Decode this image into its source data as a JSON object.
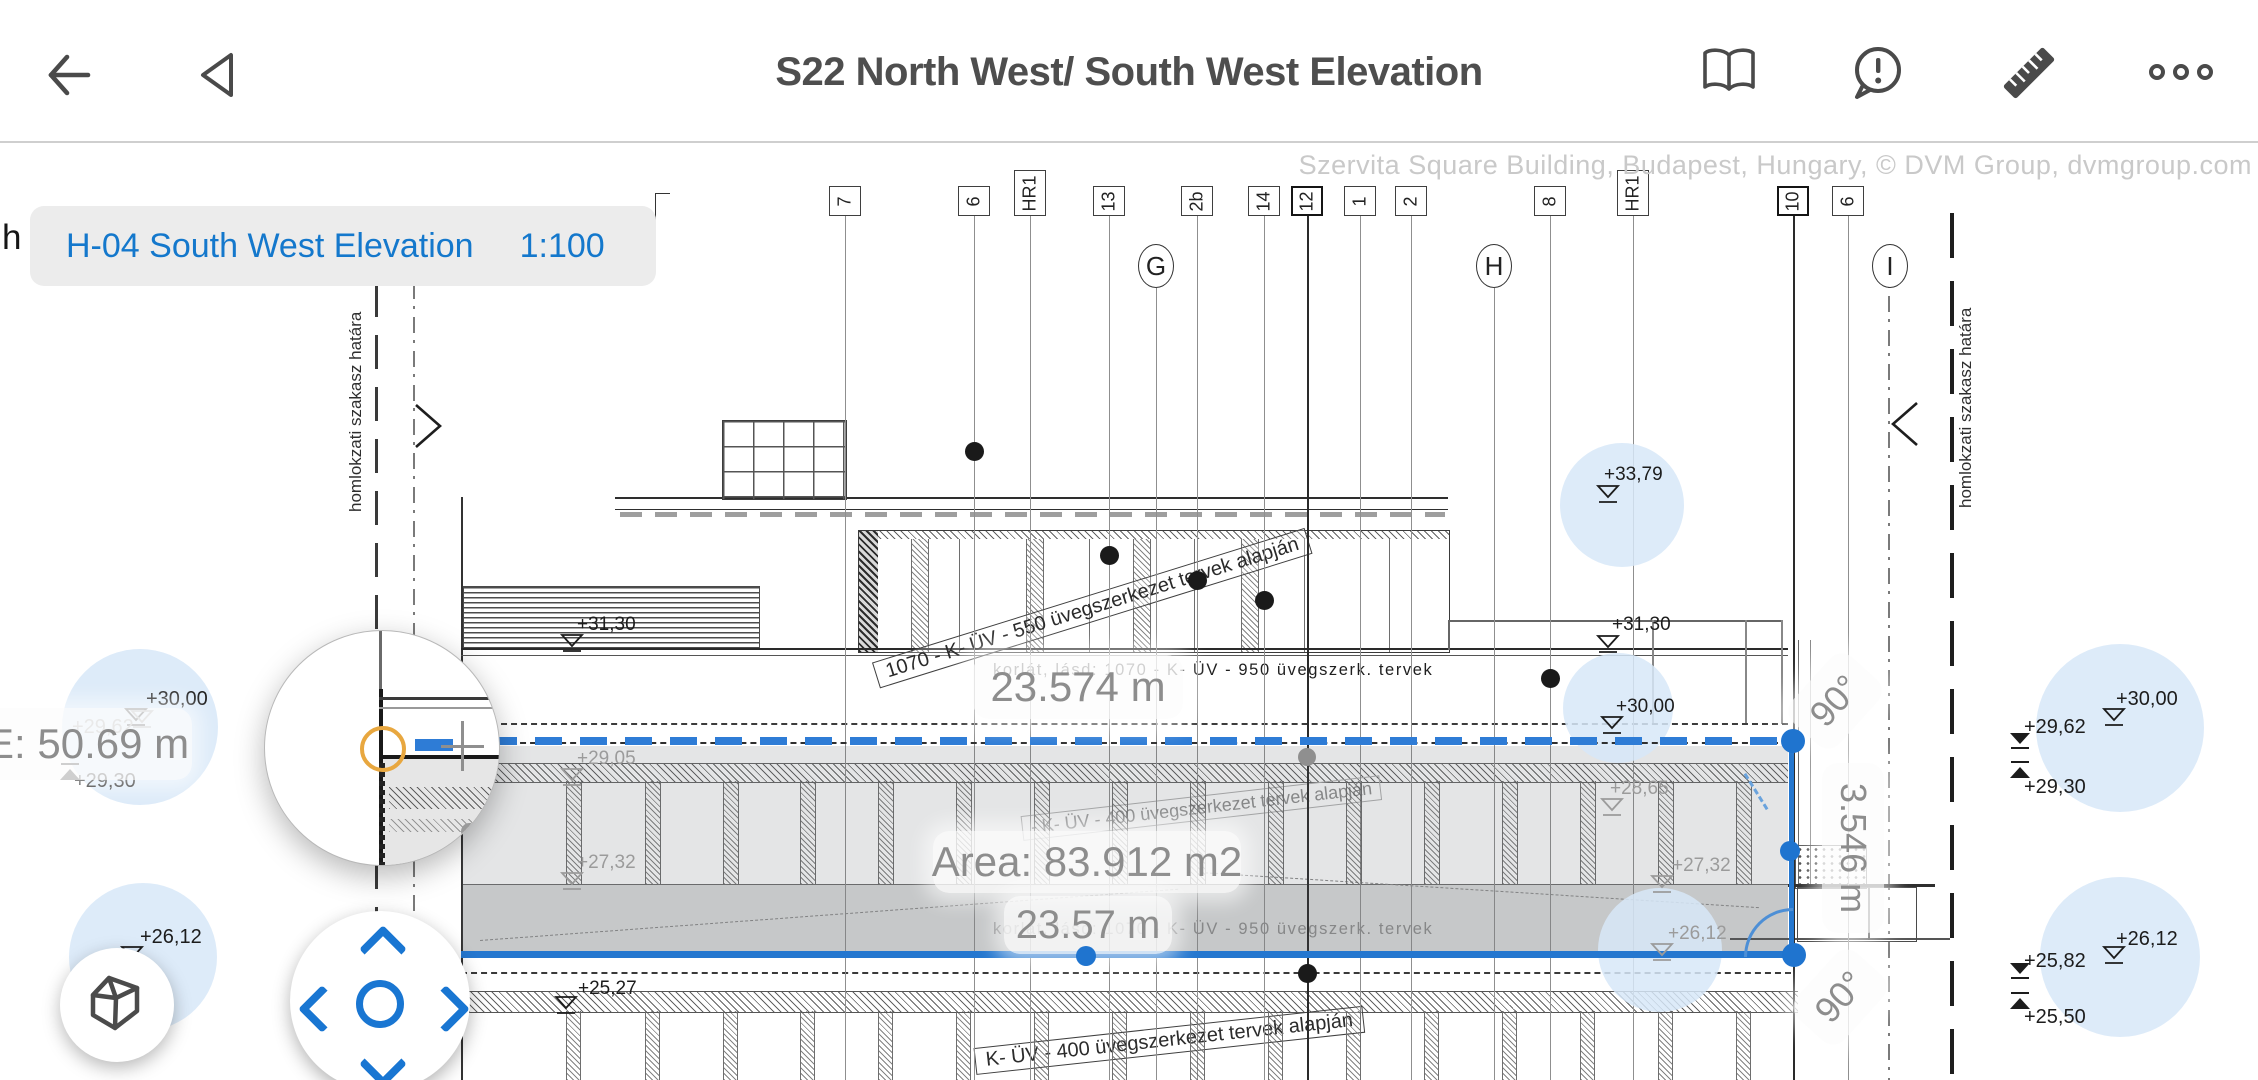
{
  "toolbar": {
    "title": "S22 North West/ South West Elevation"
  },
  "chip": {
    "label": "H-04 South West Elevation",
    "scale": "1:100"
  },
  "watermark": "Szervita Square Building, Budapest, Hungary, © DVM Group, dvmgroup.com",
  "edge_text": "h",
  "boundary_label": "homlokzati szakasz határa",
  "measurements": {
    "length_top": "23.574 m",
    "area": "Area: 83.912 m2",
    "length_bottom": "23.57 m",
    "total_left": "E: 50.69 m",
    "height_right": "3.546 m",
    "angle_top": "90°",
    "angle_bottom": "90°"
  },
  "notes": {
    "railing": "korlát, lásd: 1070 - K- ÜV - 950 üvegszerk. tervek",
    "glass_550": "1070 - K- ÜV - 550 üvegszerkezet tervek alapján",
    "glass_400": "- K- ÜV - 400 üvegszerkezet tervek alapján",
    "glass_400_lower": "K- ÜV - 400 üvegszerkezet tervek alapján"
  },
  "grid": {
    "boxes": [
      {
        "l": "7",
        "x": 845
      },
      {
        "l": "6",
        "x": 974
      },
      {
        "l": "HR1",
        "x": 1030,
        "tall": true
      },
      {
        "l": "13",
        "x": 1109
      },
      {
        "l": "2b",
        "x": 1197
      },
      {
        "l": "14",
        "x": 1264
      },
      {
        "l": "12",
        "x": 1307,
        "bold": true
      },
      {
        "l": "1",
        "x": 1360
      },
      {
        "l": "2",
        "x": 1411
      },
      {
        "l": "8",
        "x": 1550
      },
      {
        "l": "HR1",
        "x": 1633,
        "tall": true
      },
      {
        "l": "10",
        "x": 1793,
        "bold": true
      },
      {
        "l": "6",
        "x": 1848
      }
    ],
    "circles": [
      {
        "l": "G",
        "x": 1156,
        "y": 266
      },
      {
        "l": "H",
        "x": 1494,
        "y": 266
      },
      {
        "l": "I",
        "x": 1890,
        "y": 266
      }
    ]
  },
  "levels": {
    "overlay": [
      {
        "t": "+30,00",
        "x": 146,
        "y": 688,
        "mx": 124,
        "my": 708,
        "s": "od"
      },
      {
        "t": "+29,62",
        "x": 72,
        "y": 716,
        "mx": 130,
        "my": 710,
        "s": "od",
        "gray": true
      },
      {
        "t": "+29,30",
        "x": 74,
        "y": 770,
        "mx": 58,
        "my": 762,
        "s": "fu"
      },
      {
        "t": "+26,12",
        "x": 140,
        "y": 926,
        "mx": 120,
        "my": 946,
        "s": "od"
      },
      {
        "t": "+30,00",
        "x": 2116,
        "y": 688,
        "mx": 2102,
        "my": 708,
        "s": "od"
      },
      {
        "t": "+29,62",
        "x": 2024,
        "y": 716,
        "mx": 2008,
        "my": 732,
        "s": "fd"
      },
      {
        "t": "+29,30",
        "x": 2024,
        "y": 776,
        "mx": 2008,
        "my": 760,
        "s": "fu"
      },
      {
        "t": "+26,12",
        "x": 2116,
        "y": 928,
        "mx": 2102,
        "my": 946,
        "s": "od"
      },
      {
        "t": "+25,82",
        "x": 2024,
        "y": 950,
        "mx": 2008,
        "my": 962,
        "s": "fd"
      },
      {
        "t": "+25,50",
        "x": 2024,
        "y": 1006,
        "mx": 2008,
        "my": 991,
        "s": "fu"
      }
    ],
    "drawing": [
      {
        "t": "+33,79",
        "x": 1604,
        "y": 464,
        "mx": 1596,
        "my": 485,
        "s": "od"
      },
      {
        "t": "+31,30",
        "x": 1612,
        "y": 614,
        "mx": 1596,
        "my": 635,
        "s": "od"
      },
      {
        "t": "+30,00",
        "x": 1616,
        "y": 696,
        "mx": 1600,
        "my": 716,
        "s": "od"
      },
      {
        "t": "+28,65",
        "x": 1610,
        "y": 778,
        "mx": 1600,
        "my": 798,
        "s": "od",
        "gray": true
      },
      {
        "t": "+27,32",
        "x": 1672,
        "y": 855,
        "mx": 1650,
        "my": 875,
        "s": "od",
        "gray": true
      },
      {
        "t": "+26,12",
        "x": 1668,
        "y": 923,
        "mx": 1650,
        "my": 943,
        "s": "od",
        "gray": true
      },
      {
        "t": "+31,30",
        "x": 577,
        "y": 614,
        "mx": 560,
        "my": 634,
        "s": "od"
      },
      {
        "t": "+29,05",
        "x": 577,
        "y": 748,
        "mx": 560,
        "my": 768,
        "s": "od",
        "gray": true
      },
      {
        "t": "+27,32",
        "x": 577,
        "y": 852,
        "mx": 560,
        "my": 872,
        "s": "od",
        "gray": true
      },
      {
        "t": "+25,27",
        "x": 578,
        "y": 978,
        "mx": 554,
        "my": 996,
        "s": "od"
      }
    ]
  },
  "bubbles": [
    {
      "x": 140,
      "y": 727,
      "r": 78
    },
    {
      "x": 143,
      "y": 957,
      "r": 74
    },
    {
      "x": 1622,
      "y": 505,
      "r": 62
    },
    {
      "x": 1618,
      "y": 708,
      "r": 55
    },
    {
      "x": 1660,
      "y": 950,
      "r": 62
    },
    {
      "x": 2120,
      "y": 728,
      "r": 84
    },
    {
      "x": 2120,
      "y": 957,
      "r": 80
    }
  ],
  "dots": {
    "black": [
      [
        974,
        451
      ],
      [
        1109,
        555
      ],
      [
        1197,
        580
      ],
      [
        1264,
        600
      ],
      [
        1550,
        678
      ],
      [
        1307,
        973
      ]
    ],
    "gray": [
      {
        "x": 1307,
        "y": 757,
        "r": 9
      }
    ],
    "blue": [
      {
        "x": 1793,
        "y": 741,
        "r": 12
      },
      {
        "x": 1790,
        "y": 851,
        "r": 10
      },
      {
        "x": 1794,
        "y": 955,
        "r": 12
      },
      {
        "x": 1086,
        "y": 956,
        "r": 10
      }
    ]
  },
  "accent": {
    "blue": "#2a7cd4",
    "highlight": "#d7e7f8",
    "orange": "#e8a73f"
  }
}
